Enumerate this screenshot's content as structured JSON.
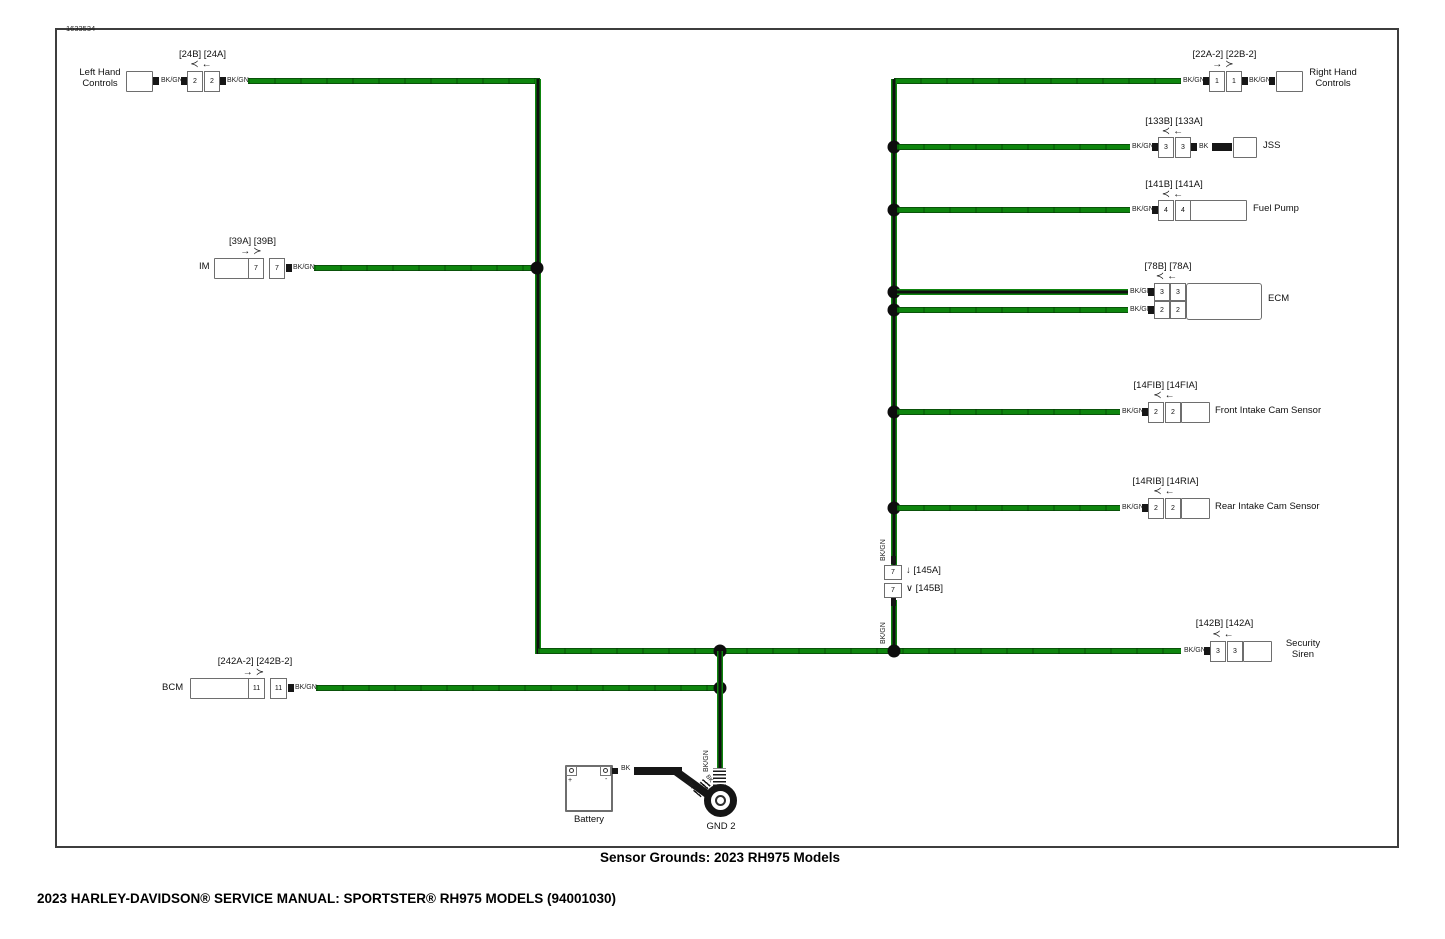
{
  "page": {
    "figure_number": "1633534",
    "caption": "Sensor Grounds: 2023 RH975 Models",
    "footer": "2023 HARLEY-DAVIDSON® SERVICE MANUAL: SPORTSTER® RH975 MODELS (94001030)"
  },
  "labels": {
    "bkgn": "BK/GN",
    "bk": "BK",
    "arrow_left": "≺←",
    "arrow_right": "→≻",
    "arrow_down": "↓",
    "socket_down": "∨"
  },
  "colors": {
    "wire_green": "#0e850e",
    "wire_black": "#161616"
  },
  "components": {
    "left_hand_controls": {
      "name_line1": "Left Hand",
      "name_line2": "Controls",
      "refs": "[24B] [24A]",
      "pin_b": "2",
      "pin_a": "2"
    },
    "right_hand_controls": {
      "name_line1": "Right Hand",
      "name_line2": "Controls",
      "refs": "[22A-2] [22B-2]",
      "pin_a": "1",
      "pin_b": "1"
    },
    "jss": {
      "name": "JSS",
      "refs": "[133B] [133A]",
      "pin_b": "3",
      "pin_a": "3"
    },
    "fuel_pump": {
      "name": "Fuel Pump",
      "refs": "[141B] [141A]",
      "pin_b": "4",
      "pin_a": "4"
    },
    "ecm": {
      "name": "ECM",
      "refs": "[78B] [78A]",
      "row1_pin_b": "3",
      "row1_pin_a": "3",
      "row2_pin_b": "2",
      "row2_pin_a": "2"
    },
    "front_intake_cam_sensor": {
      "name": "Front Intake Cam Sensor",
      "refs": "[14FIB] [14FIA]",
      "pin_b": "2",
      "pin_a": "2"
    },
    "rear_intake_cam_sensor": {
      "name": "Rear Intake Cam Sensor",
      "refs": "[14RIB] [14RIA]",
      "pin_b": "2",
      "pin_a": "2"
    },
    "inline_connector_145": {
      "pin_a": "7",
      "pin_b": "7",
      "ref_a": "[145A]",
      "ref_b": "[145B]"
    },
    "security_siren": {
      "name_line1": "Security",
      "name_line2": "Siren",
      "refs": "[142B] [142A]",
      "pin_b": "3",
      "pin_a": "3"
    },
    "im": {
      "name": "IM",
      "refs": "[39A] [39B]",
      "pin_a": "7",
      "pin_b": "7"
    },
    "bcm": {
      "name": "BCM",
      "refs": "[242A-2] [242B-2]",
      "pin_a": "11",
      "pin_b": "11"
    },
    "battery": {
      "name": "Battery",
      "positive": "+",
      "negative": "-"
    },
    "ground": {
      "name": "GND 2"
    }
  }
}
